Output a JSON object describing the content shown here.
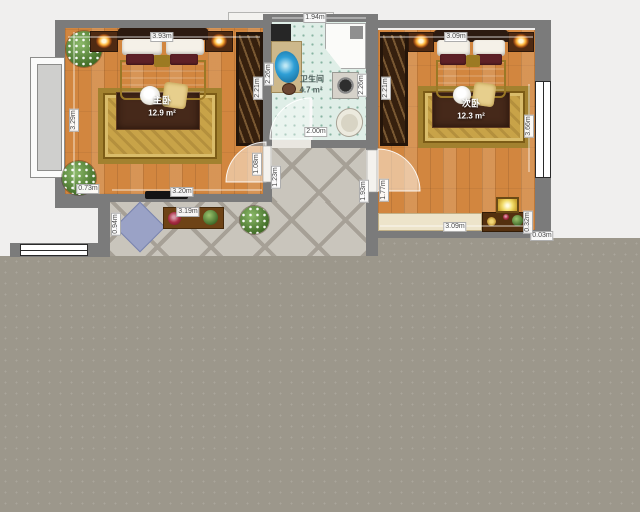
{
  "rooms": {
    "master": {
      "name": "主卧",
      "area": "12.9 m²"
    },
    "second": {
      "name": "次卧",
      "area": "12.3 m²"
    },
    "bath": {
      "name": "卫生间",
      "area": "4.7 m²"
    }
  },
  "dims": {
    "master_top": "3.93m",
    "master_left": "3.29m",
    "master_closet": "2.21m",
    "master_door": "1.08m",
    "master_bottom_left": "0.73m",
    "master_bottom": "3.20m",
    "bath_top": "1.94m",
    "bath_left": "2.26m",
    "bath_right": "2.26m",
    "bath_bottom": "2.00m",
    "corridor_width": "1.23m",
    "corridor_length": "1.93m",
    "second_top": "3.09m",
    "second_closet": "2.21m",
    "second_right": "3.66m",
    "second_door": "1.77m",
    "second_bottom": "3.09m",
    "second_gap": "0.32m",
    "second_outer": "0.03m",
    "hall_depth": "0.94m",
    "hall_cabinet": "3.19m"
  },
  "colors": {
    "wood_floor": "#d2863f",
    "tile_floor": "#c9c5bc",
    "bath_floor": "#dfeee7",
    "wall": "#7b7b7b",
    "outside": "#9c978b",
    "sink_accent": "#2f9fd6",
    "rug_gold": "#c8a348"
  }
}
